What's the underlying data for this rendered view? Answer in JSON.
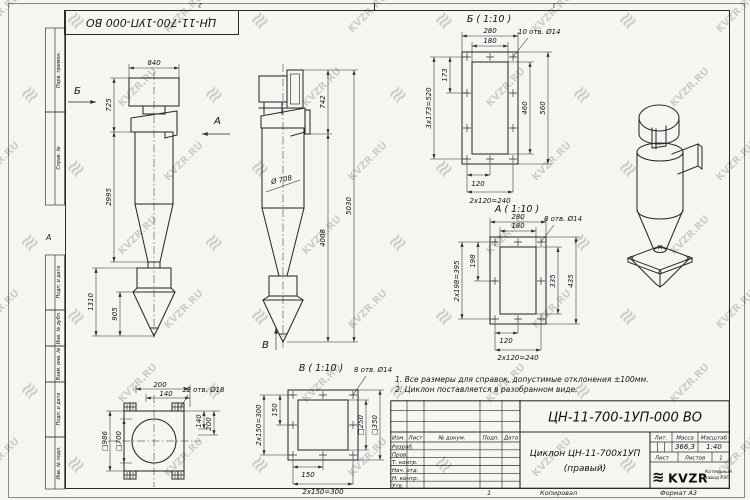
{
  "watermark": {
    "text": "KVZR.RU",
    "logo_glyph": "≋"
  },
  "frame": {
    "designation_top": "ЦН-11-700-1УП-000 ВО",
    "zone_2": "2",
    "zone_1": "1",
    "zone_a": "А",
    "stamp_column": [
      "Перв. примен.",
      "Справ. №",
      "Подп. и дата",
      "Инв. № дубл.",
      "Взам. инв. №",
      "Подп. и дата",
      "Инв. № подл."
    ]
  },
  "notes": {
    "line1": "1. Все размеры для справок, допустимые отклонения ±100мм.",
    "line2": "2. Циклон поставляется в разобранном виде."
  },
  "title_block": {
    "designation": "ЦН-11-700-1УП-000 ВО",
    "name_line1": "Циклон ЦН-11-700х1УП",
    "name_line2": "(правый)",
    "col_izm": "Изм.",
    "col_list": "Лист",
    "col_dokum": "№ докум.",
    "col_podp": "Подп.",
    "col_data": "Дата",
    "row_razrab": "Разраб.",
    "row_prov": "Пров.",
    "row_tkontr": "Т. контр.",
    "row_nachotd": "Нач. отд.",
    "row_nkontr": "Н. контр.",
    "row_utv": "Утв.",
    "lit_label": "Лит.",
    "mass_label": "Масса",
    "scale_label": "Масштаб",
    "mass_value": "366,3",
    "scale_value": "1:40",
    "list_label": "Лист",
    "listov_label": "Листов",
    "listov_value": "1",
    "logo_text": "KVZR",
    "logo_sub1": "Котельный",
    "logo_sub2": "завод РЭП",
    "copied": "Копировал",
    "format": "Формат А3",
    "bottom_num": "1"
  },
  "views": {
    "front": {
      "label_b": "Б",
      "label_a": "А",
      "dim_840": "840",
      "dim_725": "725",
      "dim_2995": "2995",
      "dim_1310": "1310",
      "dim_905": "905"
    },
    "side": {
      "label_v": "В",
      "dim_d708": "Ø 708",
      "dim_742": "742",
      "dim_5030": "5030",
      "dim_4008": "4008"
    },
    "b": {
      "title": "Б ( 1:10 )",
      "dim_280": "280",
      "dim_180": "180",
      "holes": "10 отв. Ø14",
      "dim_173": "173",
      "dim_520": "3х173=520",
      "dim_460": "460",
      "dim_560": "560",
      "dim_120": "120",
      "dim_240": "2х120=240"
    },
    "a": {
      "title": "А ( 1:10 )",
      "dim_280": "280",
      "dim_180": "180",
      "holes": "8 отв. Ø14",
      "dim_198": "198",
      "dim_395": "2х198=395",
      "dim_335": "335",
      "dim_435": "435",
      "dim_120": "120",
      "dim_240": "2х120=240"
    },
    "v": {
      "title": "В ( 1:10 )",
      "holes": "8 отв. Ø14",
      "dim_150l": "150",
      "dim_300l": "2х150=300",
      "dim_250": "□250",
      "dim_350": "□350",
      "dim_150b": "150",
      "dim_300b": "2х150=300"
    },
    "flange": {
      "dim_200t": "200",
      "dim_140t": "140",
      "holes": "12 отв. Ø18",
      "dim_140r": "140",
      "dim_200r": "200",
      "dim_986": "□986",
      "dim_700": "□700"
    }
  }
}
